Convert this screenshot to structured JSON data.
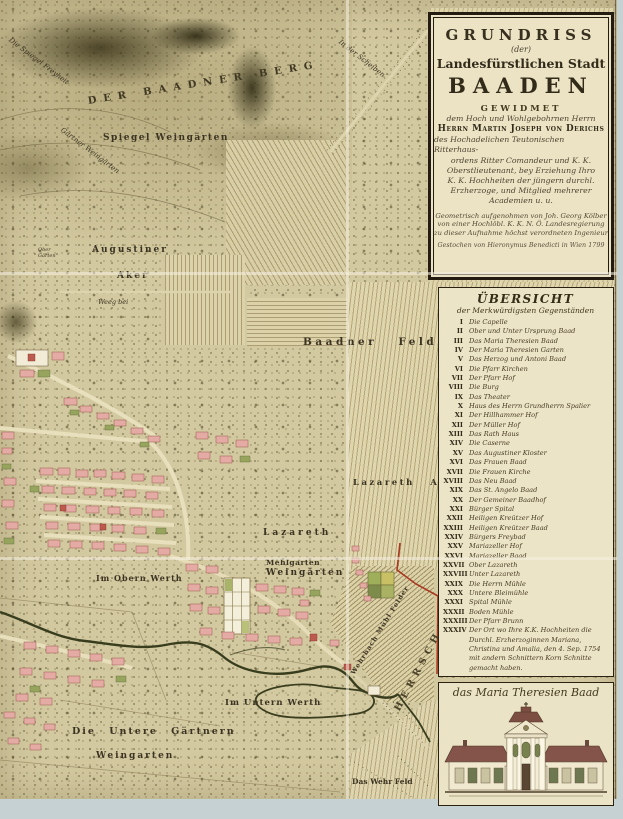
{
  "cartouche": {
    "title_line1": "GRUNDRISS",
    "title_line2": "(der)",
    "title_line3": "Landesfürstlichen Stadt",
    "title_line4": "BAADEN",
    "dedication_heading": "GEWIDMET",
    "dedication_line1": "dem Hoch und Wohlgebohrnen Herrn",
    "dedication_name": "Herrn Martin Joseph von Derichs",
    "dedication_line2": "des Hochadelichen Teutonischen Ritterhaus-",
    "dedication_line3": "ordens Ritter Comandeur und K. K.",
    "dedication_line4": "Oberstlieutenant, bey Erziehung Ihro",
    "dedication_line5": "K. K. Hochheiten der jüngern durchl.",
    "dedication_line6": "Erzherzoge, und Mitglied mehrerer",
    "dedication_line7": "Academien u. u.",
    "surveyor_line1": "Geometrisch aufgenohmen von Joh. Georg Kölber",
    "surveyor_line2": "von einer Hochlöbl. K. K. N. Ö. Landesregierung",
    "surveyor_line3": "zu dieser Aufnahme höchst verordneten Ingenieur",
    "engraver_line": "Gestochen von Hieronymus Benedicti in Wien 1799"
  },
  "legend": {
    "title": "ÜBERSICHT",
    "subtitle": "der Merkwürdigsten Gegenständen",
    "items": [
      {
        "roman": "I",
        "label": "Die Capelle"
      },
      {
        "roman": "II",
        "label": "Ober und Unter Ursprung Baad"
      },
      {
        "roman": "III",
        "label": "Das Maria Theresien Baad"
      },
      {
        "roman": "IV",
        "label": "Der Maria Theresien Garten"
      },
      {
        "roman": "V",
        "label": "Das Herzog und Antoni Baad"
      },
      {
        "roman": "VI",
        "label": "Die Pfarr Kirchen"
      },
      {
        "roman": "VII",
        "label": "Der Pfarr Hof"
      },
      {
        "roman": "VIII",
        "label": "Die Burg"
      },
      {
        "roman": "IX",
        "label": "Das Theater"
      },
      {
        "roman": "X",
        "label": "Haus des Herrn Grundherrn Spalier"
      },
      {
        "roman": "XI",
        "label": "Der Hillhammer Hof"
      },
      {
        "roman": "XII",
        "label": "Der Müller Hof"
      },
      {
        "roman": "XIII",
        "label": "Das Rath Haus"
      },
      {
        "roman": "XIV",
        "label": "Die Caserne"
      },
      {
        "roman": "XV",
        "label": "Das Augustiner Kloster"
      },
      {
        "roman": "XVI",
        "label": "Das Frauen Baad"
      },
      {
        "roman": "XVII",
        "label": "Die Frauen Kirche"
      },
      {
        "roman": "XVIII",
        "label": "Das Neu Baad"
      },
      {
        "roman": "XIX",
        "label": "Das St. Angelo Baad"
      },
      {
        "roman": "XX",
        "label": "Der Gemeiner Baadhof"
      },
      {
        "roman": "XXI",
        "label": "Bürger Spital"
      },
      {
        "roman": "XXII",
        "label": "Heiligen Kreützer Hof"
      },
      {
        "roman": "XXIII",
        "label": "Heiligen Kreützer Baad"
      },
      {
        "roman": "XXIV",
        "label": "Bürgers Freybad"
      },
      {
        "roman": "XXV",
        "label": "Mariazeller Hof"
      },
      {
        "roman": "XXVI",
        "label": "Mariazeller Baad"
      },
      {
        "roman": "XXVII",
        "label": "Ober Lazareth"
      },
      {
        "roman": "XXVIII",
        "label": "Unter Lazareth"
      },
      {
        "roman": "XXIX",
        "label": "Die Herrn Mühle"
      },
      {
        "roman": "XXX",
        "label": "Untere Bleimühle"
      },
      {
        "roman": "XXXI",
        "label": "Spital Mühle"
      },
      {
        "roman": "XXXII",
        "label": "Boden Mühle"
      },
      {
        "roman": "XXXIII",
        "label": "Der Pfarr Brunn"
      },
      {
        "roman": "XXXIV",
        "label": "Der Ort wo Ihre K.K. Hochheiten die Durchl. Erzherzoginnen Mariana, Christina und Amalia, den 4. Sep. 1754 mit andern Schnittern Korn Schnitte gemacht haben."
      }
    ]
  },
  "picture": {
    "caption": "das Maria Theresien Baad"
  },
  "map_labels": {
    "berg": "DER BAADNER BERG",
    "spiegel_freyheit": "Die Spiegel Freyheit",
    "gaertner_weingaerten": "Gärtner Weingärten",
    "spiegel_weingaerten": "Spiegel Weingärten",
    "augustiner": "Augustiner",
    "aker": "Aker",
    "ober_gaerten": "Ober Gärten",
    "weeg_bei": "Weeg bei",
    "in_der_scheiben": "In der Scheiben",
    "baadner_feld": "Baadner Feld",
    "lazareth_aker": "Lazareth Aker",
    "lazareth": "Lazareth",
    "weingaerten": "Weingärten",
    "im_obern_werth": "Im Obern Werth",
    "mehlgarten": "Mehlgarten",
    "wehrbach": "Wehrbach Mühl Felder",
    "herrschaft_leesdorf": "HERRSCHAFT LEESDORF",
    "im_untern_werth": "Im Untern Werth",
    "die_untere_gaertnern": "Die Untere Gärtnern",
    "weingarten": "Weingarten",
    "das_wehr_feld": "Das Wehr Feld"
  },
  "colors": {
    "paper": "#d3c9a0",
    "margin_blue": "#c6d1d4",
    "building_pink": "#e3aba3",
    "boundary_red": "#a83820",
    "hill_dark": "#3f3920",
    "panel_cream": "#ece3c6"
  }
}
